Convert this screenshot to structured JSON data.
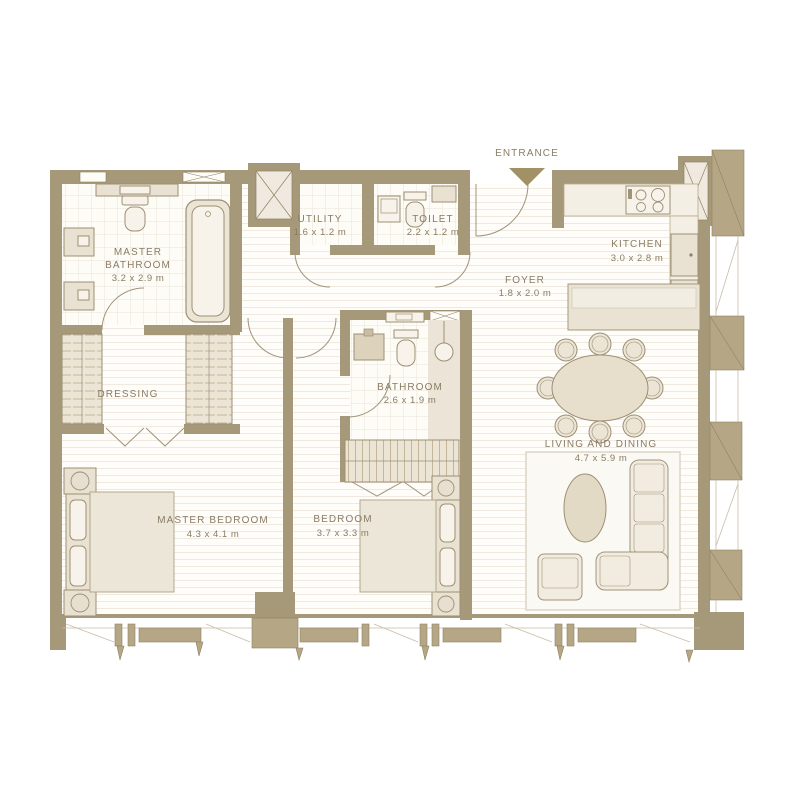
{
  "entrance": {
    "label": "ENTRANCE"
  },
  "rooms": [
    {
      "id": "master-bathroom",
      "name_lines": [
        "MASTER",
        "BATHROOM"
      ],
      "dims": "3.2 x 2.9 m"
    },
    {
      "id": "utility",
      "name": "UTILITY",
      "dims": "1.6 x 1.2 m"
    },
    {
      "id": "toilet",
      "name": "TOILET",
      "dims": "2.2 x 1.2 m"
    },
    {
      "id": "kitchen",
      "name": "KITCHEN",
      "dims": "3.0 x 2.8 m"
    },
    {
      "id": "foyer",
      "name": "FOYER",
      "dims": "1.8 x 2.0 m"
    },
    {
      "id": "dressing",
      "name": "DRESSING",
      "dims": ""
    },
    {
      "id": "bathroom",
      "name": "BATHROOM",
      "dims": "2.6 x 1.9 m"
    },
    {
      "id": "master-bedroom",
      "name": "MASTER BEDROOM",
      "dims": "4.3 x 4.1 m"
    },
    {
      "id": "bedroom",
      "name": "BEDROOM",
      "dims": "3.7 x 3.3 m"
    },
    {
      "id": "living-dining",
      "name": "LIVING AND DINING",
      "dims": "4.7 x 5.9 m"
    }
  ],
  "colors": {
    "wall": "#a6997a",
    "pilaster": "#b5a786",
    "accent_arrow": "#a39166",
    "text": "#8a7c63",
    "floor_line": "#efe9df",
    "furniture_fill": "#ece5d6",
    "furniture_stroke": "#9d8f73",
    "background": "#ffffff"
  }
}
